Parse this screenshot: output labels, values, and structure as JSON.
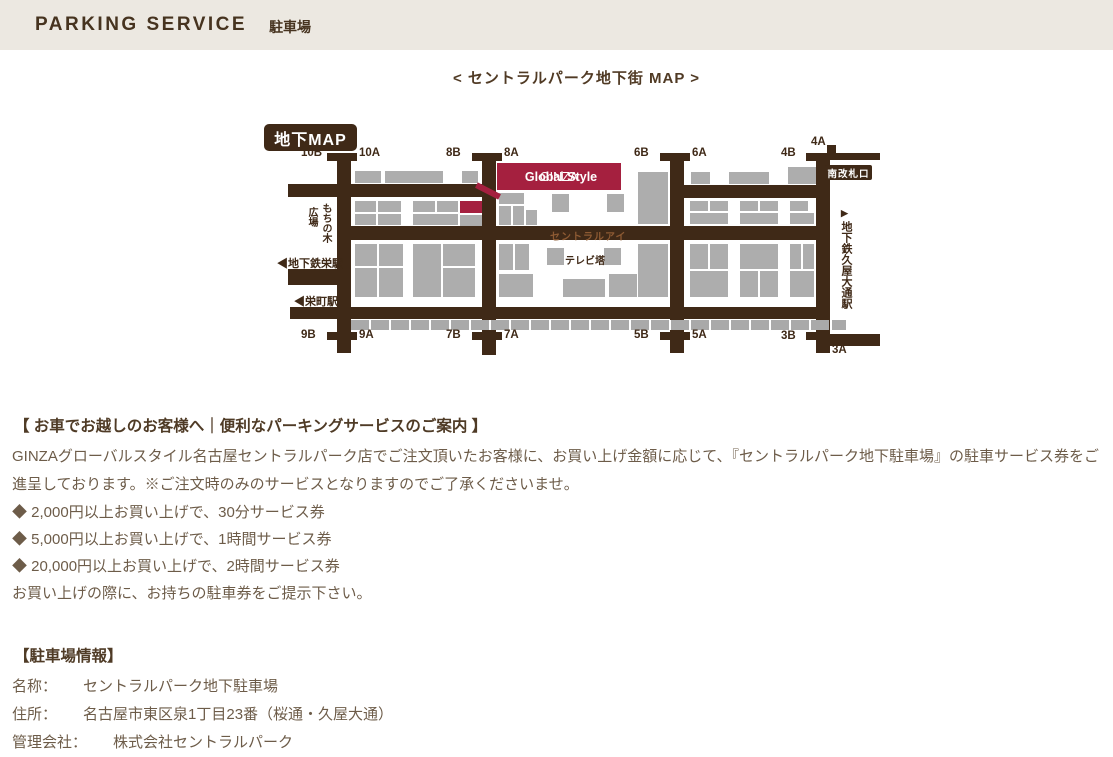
{
  "header": {
    "title": "PARKING SERVICE",
    "subtitle": "駐車場"
  },
  "map_title": "< セントラルパーク地下街 MAP >",
  "map": {
    "badge": "地下MAP",
    "banner_brand": "GINZA",
    "banner_name": "Global Style",
    "south_gate": "南改札口",
    "central_eye": "セントラルアイ",
    "tv_tower": "テレビ塔",
    "hiroba": "広場",
    "mochinoki": "もちの木",
    "sakae_subway": "◀地下鉄栄駅",
    "sakaemachi": "◀栄町駅",
    "hisaya_arrow": "▶",
    "hisaya": "地下鉄久屋大通駅",
    "colors": {
      "corridor_brown": "#3f2917",
      "shop_gray": "#adadad",
      "accent_red": "#a5203f"
    },
    "exits": [
      {
        "label": "10B",
        "x": 38,
        "y": 30
      },
      {
        "label": "10A",
        "x": 96,
        "y": 30
      },
      {
        "label": "8B",
        "x": 183,
        "y": 30
      },
      {
        "label": "8A",
        "x": 241,
        "y": 30
      },
      {
        "label": "6B",
        "x": 371,
        "y": 30
      },
      {
        "label": "6A",
        "x": 429,
        "y": 30
      },
      {
        "label": "4B",
        "x": 518,
        "y": 30
      },
      {
        "label": "4A",
        "x": 548,
        "y": 19
      },
      {
        "label": "9B",
        "x": 38,
        "y": 212
      },
      {
        "label": "9A",
        "x": 96,
        "y": 212
      },
      {
        "label": "7B",
        "x": 183,
        "y": 212
      },
      {
        "label": "7A",
        "x": 241,
        "y": 212
      },
      {
        "label": "5B",
        "x": 371,
        "y": 212
      },
      {
        "label": "5A",
        "x": 429,
        "y": 212
      },
      {
        "label": "3B",
        "x": 518,
        "y": 213
      },
      {
        "label": "3A",
        "x": 569,
        "y": 227
      }
    ],
    "shops": [
      [
        92,
        54,
        26,
        12
      ],
      [
        122,
        54,
        58,
        12
      ],
      [
        199,
        54,
        16,
        12
      ],
      [
        92,
        84,
        21,
        11
      ],
      [
        115,
        84,
        23,
        11
      ],
      [
        92,
        97,
        21,
        11
      ],
      [
        115,
        97,
        23,
        11
      ],
      [
        150,
        84,
        22,
        11
      ],
      [
        174,
        84,
        21,
        11
      ],
      [
        150,
        97,
        45,
        11
      ],
      [
        197,
        98,
        22,
        11
      ],
      [
        236,
        76,
        25,
        11
      ],
      [
        236,
        89,
        12,
        19
      ],
      [
        250,
        89,
        11,
        19
      ],
      [
        263,
        93,
        11,
        15
      ],
      [
        289,
        77,
        17,
        18
      ],
      [
        344,
        77,
        17,
        18
      ],
      [
        375,
        55,
        30,
        52
      ],
      [
        428,
        55,
        19,
        12
      ],
      [
        466,
        55,
        40,
        12
      ],
      [
        525,
        50,
        28,
        17
      ],
      [
        427,
        84,
        18,
        10
      ],
      [
        447,
        84,
        18,
        10
      ],
      [
        427,
        96,
        38,
        11
      ],
      [
        477,
        84,
        18,
        10
      ],
      [
        497,
        84,
        18,
        10
      ],
      [
        477,
        96,
        38,
        11
      ],
      [
        527,
        84,
        18,
        10
      ],
      [
        527,
        96,
        24,
        11
      ],
      [
        92,
        127,
        22,
        22
      ],
      [
        116,
        127,
        24,
        22
      ],
      [
        92,
        151,
        22,
        29
      ],
      [
        116,
        151,
        24,
        29
      ],
      [
        150,
        127,
        28,
        53
      ],
      [
        180,
        127,
        32,
        22
      ],
      [
        180,
        151,
        32,
        29
      ],
      [
        236,
        127,
        14,
        26
      ],
      [
        252,
        127,
        14,
        26
      ],
      [
        284,
        131,
        17,
        17
      ],
      [
        341,
        131,
        17,
        17
      ],
      [
        236,
        157,
        34,
        23
      ],
      [
        300,
        162,
        42,
        18
      ],
      [
        346,
        157,
        28,
        23
      ],
      [
        375,
        127,
        30,
        53
      ],
      [
        427,
        127,
        18,
        25
      ],
      [
        447,
        127,
        18,
        25
      ],
      [
        427,
        154,
        38,
        26
      ],
      [
        477,
        127,
        38,
        25
      ],
      [
        477,
        154,
        18,
        26
      ],
      [
        497,
        154,
        18,
        26
      ],
      [
        527,
        127,
        11,
        25
      ],
      [
        540,
        127,
        11,
        25
      ],
      [
        527,
        154,
        24,
        26
      ]
    ]
  },
  "service_section": {
    "heading": "【 お車でお越しのお客様へ｜便利なパーキングサービスのご案内 】",
    "body": "GINZAグローバルスタイル名古屋セントラルパーク店でご注文頂いたお客様に、お買い上げ金額に応じて、『セントラルパーク地下駐車場』の駐車サービス券をご進呈しております。※ご注文時のみのサービスとなりますのでご了承くださいませ。",
    "bullets": [
      "◆ 2,000円以上お買い上げで、30分サービス券",
      "◆ 5,000円以上お買い上げで、1時間サービス券",
      "◆ 20,000円以上お買い上げで、2時間サービス券"
    ],
    "note": "お買い上げの際に、お持ちの駐車券をご提示下さい。"
  },
  "info_section": {
    "heading": "【駐車場情報】",
    "rows": [
      {
        "label": "名称：",
        "value": "セントラルパーク地下駐車場"
      },
      {
        "label": "住所：",
        "value": "名古屋市東区泉1丁目23番（桜通・久屋大通）"
      },
      {
        "label": "管理会社：",
        "value": "株式会社セントラルパーク"
      }
    ]
  }
}
